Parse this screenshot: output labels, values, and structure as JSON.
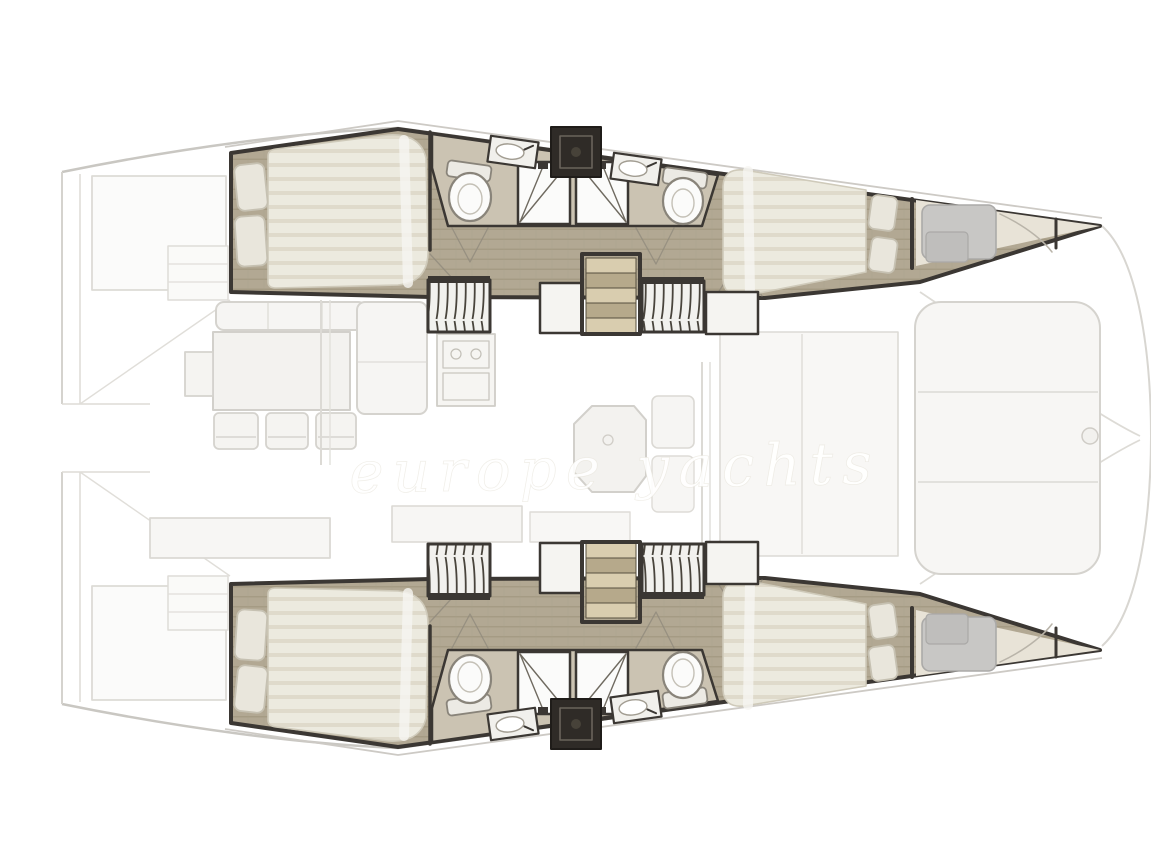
{
  "document": {
    "type": "catamaran interior layout floor plan",
    "view": "overhead plan view",
    "orientation": "bow facing right, sterns at left",
    "style": "architectural rendering; hull interiors drawn in detail, deck and saloon washed out / faint"
  },
  "watermark": {
    "text": "europe yachts",
    "style": "white cursive script across centerline"
  },
  "palette": {
    "wall_dark": "#3b3733",
    "hatch_dark": "#2f2b27",
    "teak_floor": "#b2a893",
    "teak_line": "#a1977f",
    "bath_floor": "#cbc3b2",
    "mattress": "#eceadf",
    "mattress_stripe": "#ddd7c8",
    "pillow": "#e9e6dc",
    "fixture_white": "#fbfbfa",
    "step_light": "#d9cdaf",
    "step_dark": "#b6a98b",
    "forepeak_gray": "#c8c7c5",
    "faint_stroke": "#d5d3ce",
    "faint_fill": "#f7f6f4"
  },
  "counts": {
    "cabins": 4,
    "double_berths": 4,
    "heads": 4,
    "shower_stalls": 4,
    "hanging_lockers": 4,
    "companionway_stairs": 2
  },
  "plan": {
    "hulls": [
      {
        "id": "port-hull",
        "position": "top",
        "rooms": [
          {
            "name": "aft-cabin",
            "features": [
              "double-berth",
              "two-pillows",
              "head-toward-stern"
            ]
          },
          {
            "name": "aft-head",
            "features": [
              "toilet",
              "sink",
              "shower-stall-diagonal-door"
            ]
          },
          {
            "name": "forward-head",
            "features": [
              "toilet",
              "sink",
              "shower-stall-diagonal-door"
            ]
          },
          {
            "name": "deck-hatch-unit",
            "features": [
              "dark-square-between-heads"
            ]
          },
          {
            "name": "corridor",
            "floor": "teak-planks",
            "features": [
              "door-swing-marks"
            ]
          },
          {
            "name": "companionway-stairs",
            "steps": 5
          },
          {
            "name": "hanging-locker-aft"
          },
          {
            "name": "hanging-locker-forward"
          },
          {
            "name": "forward-cabin",
            "features": [
              "double-berth",
              "two-pillows",
              "head-toward-bow"
            ]
          },
          {
            "name": "forepeak",
            "features": [
              "gray-storage-berth",
              "bow-bulkhead",
              "tapered-bow"
            ]
          }
        ]
      },
      {
        "id": "starboard-hull",
        "position": "bottom",
        "mirror_of": "port-hull"
      }
    ],
    "saloon": {
      "items": [
        {
          "name": "l-shaped-sofa"
        },
        {
          "name": "dinette-table",
          "side_tab": true
        },
        {
          "name": "dinette-chairs",
          "count": 3
        },
        {
          "name": "galley-stove-unit",
          "burners": 2
        },
        {
          "name": "galley-counter-aft"
        },
        {
          "name": "chart-table",
          "shape": "octagonal"
        },
        {
          "name": "nav-seat"
        },
        {
          "name": "mast-post-pair"
        }
      ]
    },
    "deck": {
      "items": [
        {
          "name": "stern-swim-platforms"
        },
        {
          "name": "transom-steps"
        },
        {
          "name": "sliding-door-panels"
        },
        {
          "name": "forward-cockpit-bench",
          "sections": 3
        },
        {
          "name": "bow-crossbeam-lines"
        },
        {
          "name": "bowsprit-point"
        }
      ]
    }
  }
}
